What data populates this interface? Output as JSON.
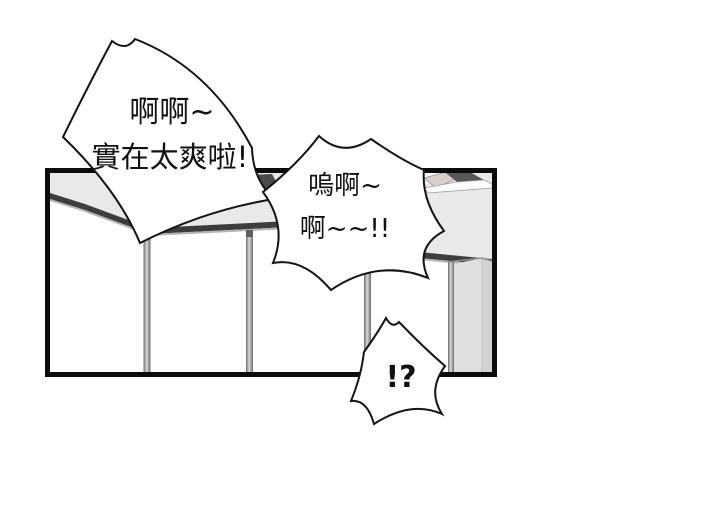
{
  "panel": {
    "type": "comic-panel",
    "border_color": "#0c0c0c",
    "wall_color": "#ffffff",
    "ceiling_color": "#e9e9eb",
    "molding_color": "#3d3d3f",
    "post_color": "#6f6f6f",
    "column_color": "#dfdfe1",
    "beam_face_color": "#dbcfcc",
    "beam_top_color": "#58585a"
  },
  "speech": {
    "bubble1": {
      "line1": "啊啊~",
      "line2": "實在太爽啦!"
    },
    "bubble2": {
      "line1": "嗚啊~",
      "line2": "啊~~!!"
    },
    "bubble3": {
      "line1": "!?"
    }
  }
}
